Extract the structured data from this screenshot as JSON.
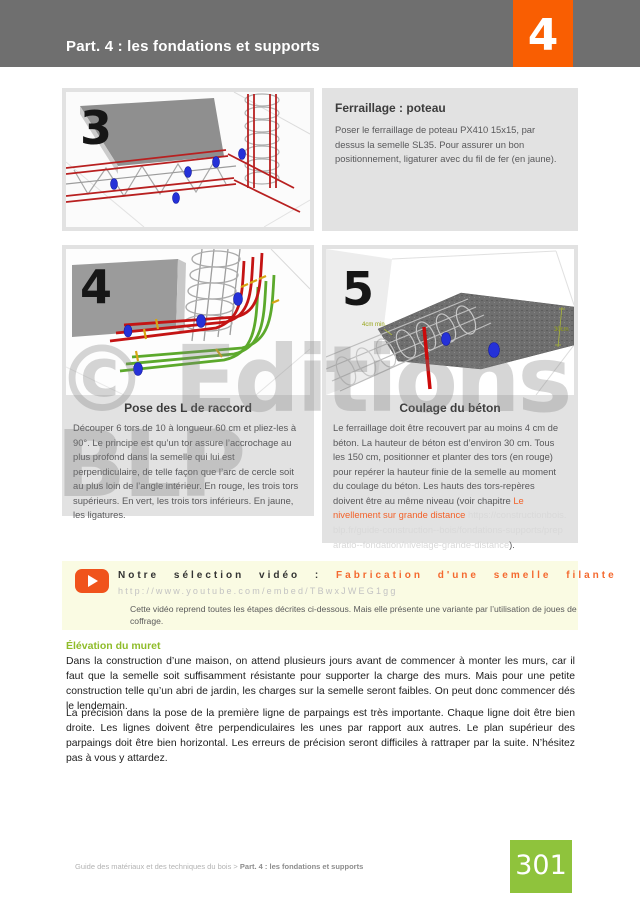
{
  "header": {
    "title": "Part. 4 : les fondations et supports",
    "chapter_number": "4"
  },
  "watermark": {
    "line1": "© Editions",
    "line2": "BLP"
  },
  "steps": [
    {
      "number": "3",
      "title": "Ferraillage : poteau",
      "body": "Poser le ferraillage de poteau PX410 15x15, par dessus la semelle SL35. Pour assurer un bon positionnement, ligaturer avec du fil de fer (en jaune)."
    },
    {
      "number": "4",
      "title": "Pose des L de raccord",
      "body": "Découper 6 tors de 10 à longueur 60 cm et pliez-les à 90°. Le principe est qu’un tor assure l’accrochage au plus profond dans la semelle qui lui est perpendiculaire, de telle façon que l’arc de cercle soit au plus loin de l’angle intérieur. En rouge, les trois tors supérieurs. En vert, les trois tors inférieurs. En jaune, les ligatures."
    },
    {
      "number": "5",
      "title": "Coulage du béton",
      "body_before_link": "Le ferraillage doit être recouvert par au moins 4 cm de béton. La hauteur de béton est d’environ 30 cm. Tous les 150 cm, positionner et planter des tors (en rouge) pour repérer la hauteur finie de la semelle au moment du coulage du béton. Les hauts des tors-repères doivent être au même niveau (voir chapitre",
      "link_text": "Le nivellement sur grande distance",
      "link_url": "https://constructionbois.blp.fr/guide-construction--bois/fondations-supports/preparatio--fondation/nivelage-grande-distance",
      "body_after_link": ").",
      "image_labels": {
        "min_cover": "4cm min.",
        "height": "30cm"
      }
    }
  ],
  "video_box": {
    "label": "Notre sélection vidéo :",
    "video_title": "Fabrication d'une semelle filante",
    "url": "http://www.youtube.com/embed/TBwxJWEG1gg",
    "description": "Cette vidéo reprend toutes les étapes décrites ci-dessous. Mais elle présente une variante par l’utilisation de joues de coffrage."
  },
  "section": {
    "heading": "Élévation du muret",
    "paragraph1": "Dans la construction d’une maison, on attend plusieurs jours avant de commencer à monter les murs, car il faut que la semelle soit suffisamment résistante pour supporter la charge des murs. Mais pour une petite construction telle qu’un abri de jardin, les charges sur la semelle seront faibles. On peut donc commencer dés le lendemain.",
    "paragraph2": "La précision dans la pose de la première ligne de parpaings est très importante. Chaque ligne doit être bien droite. Les lignes doivent être perpendiculaires les unes par rapport aux autres. Le plan supérieur des parpaings doit être bien horizontal. Les erreurs de précision seront difficiles à rattraper par la suite. N’hésitez pas à vous y attardez."
  },
  "footer": {
    "breadcrumb_plain": "Guide des matériaux et des techniques du bois > ",
    "breadcrumb_bold": "Part. 4 : les fondations et supports",
    "page_number": "301"
  },
  "colors": {
    "header_gray": "#6f6f6f",
    "accent_orange": "#f95e02",
    "link_orange": "#f2622a",
    "heading_green": "#8fbc2a",
    "page_badge_green": "#8fc33c",
    "video_box_yellow": "#fafbe3"
  }
}
